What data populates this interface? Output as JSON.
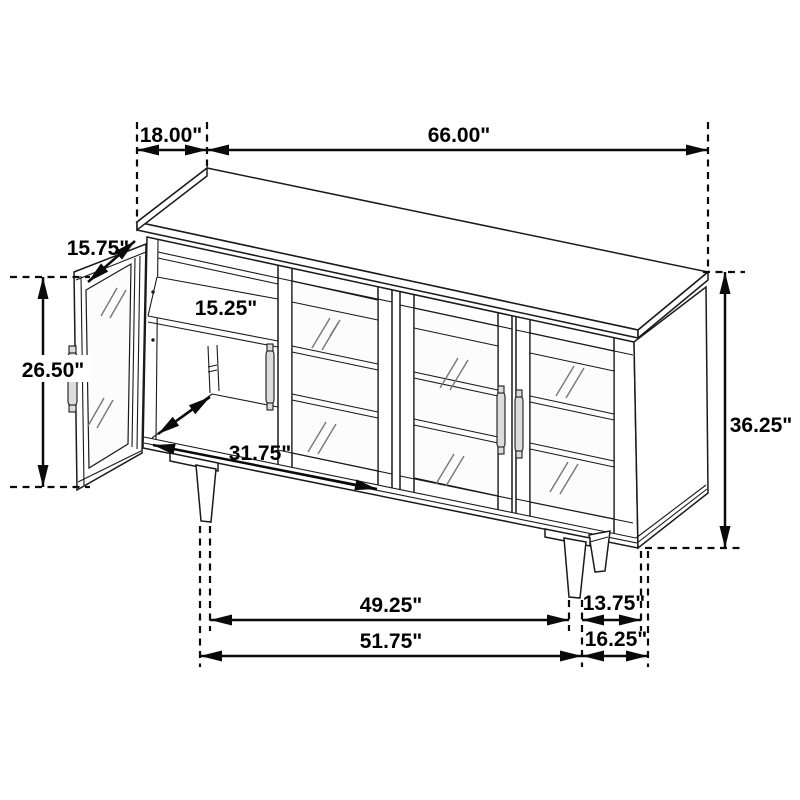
{
  "figure": {
    "type": "furniture-dimension-diagram",
    "subject": "sideboard accent cabinet with one open door, three glass doors and tapered legs",
    "background_color": "#ffffff",
    "line_color": "#1a1a1a",
    "units": "inches"
  },
  "dimensions": {
    "top_depth": {
      "label": "18.00\""
    },
    "top_width": {
      "label": "66.00\""
    },
    "door_width": {
      "label": "15.75\""
    },
    "left_height": {
      "label": "26.50\""
    },
    "shelf_depth": {
      "label": "15.25\""
    },
    "interior_width": {
      "label": "31.75\""
    },
    "overall_height": {
      "label": "36.25\""
    },
    "legs_inner_span": {
      "label": "49.25\""
    },
    "leg_front_depth": {
      "label": "13.75\""
    },
    "legs_outer_span": {
      "label": "51.75\""
    },
    "base_depth": {
      "label": "16.25\""
    }
  }
}
